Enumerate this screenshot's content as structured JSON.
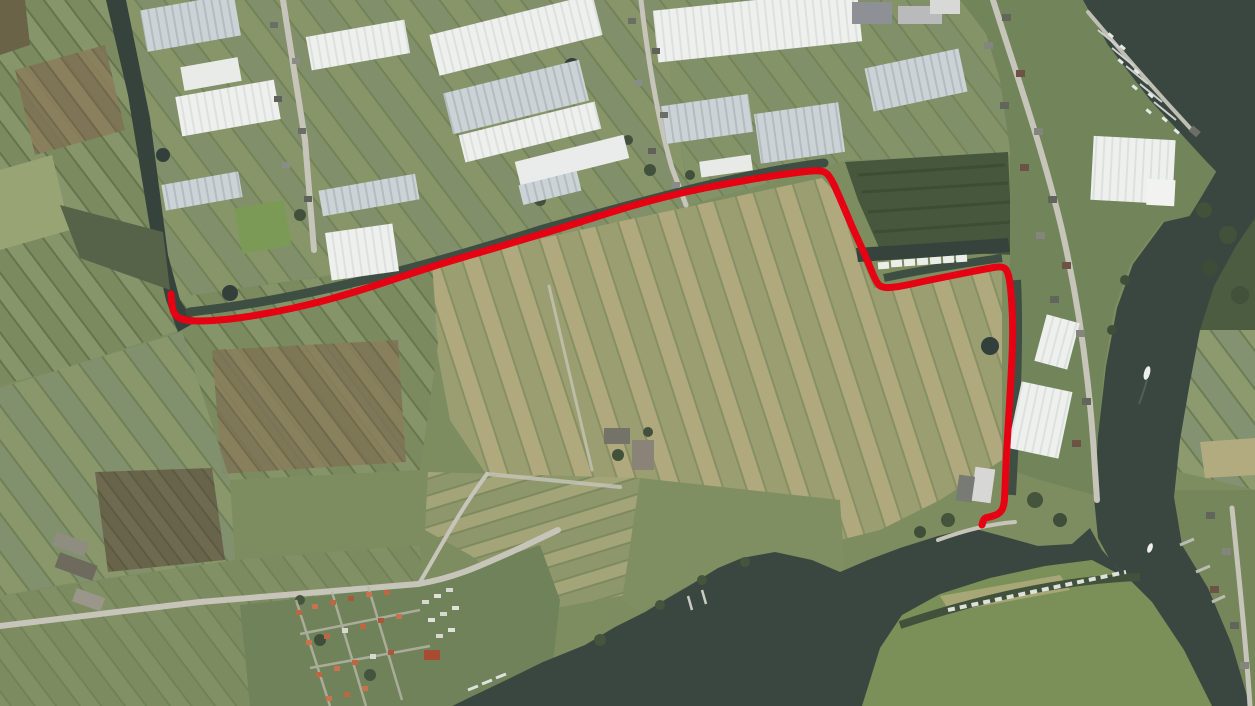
{
  "meta": {
    "type": "aerial-satellite-map",
    "description": "Aerial photo of a Dutch polder landscape with greenhouses, ribbon villages, a river system and a lake; a red route line is drawn along field ditches from a canal end in the west to a farm near the river in the south-east.",
    "visible_text": "none"
  },
  "route": {
    "color": "#e60113",
    "width": 7,
    "style": "solid",
    "points": [
      [
        171,
        294
      ],
      [
        172,
        308
      ],
      [
        176,
        317
      ],
      [
        188,
        321
      ],
      [
        210,
        321
      ],
      [
        240,
        318
      ],
      [
        275,
        312
      ],
      [
        312,
        304
      ],
      [
        352,
        293
      ],
      [
        395,
        279
      ],
      [
        440,
        264
      ],
      [
        485,
        251
      ],
      [
        525,
        239
      ],
      [
        565,
        227
      ],
      [
        605,
        214
      ],
      [
        645,
        202
      ],
      [
        685,
        192
      ],
      [
        725,
        184
      ],
      [
        765,
        177
      ],
      [
        800,
        172
      ],
      [
        822,
        170
      ],
      [
        830,
        176
      ],
      [
        840,
        198
      ],
      [
        853,
        229
      ],
      [
        866,
        257
      ],
      [
        876,
        282
      ],
      [
        882,
        288
      ],
      [
        898,
        287
      ],
      [
        925,
        281
      ],
      [
        955,
        275
      ],
      [
        985,
        269
      ],
      [
        1002,
        266
      ],
      [
        1008,
        271
      ],
      [
        1011,
        290
      ],
      [
        1013,
        325
      ],
      [
        1012,
        360
      ],
      [
        1010,
        395
      ],
      [
        1008,
        430
      ],
      [
        1006,
        462
      ],
      [
        1005,
        490
      ],
      [
        1004,
        507
      ],
      [
        999,
        514
      ],
      [
        990,
        517
      ],
      [
        984,
        518
      ],
      [
        982,
        525
      ]
    ]
  },
  "palette": {
    "water": "#3a4741",
    "water_dark": "#333f3a",
    "field_green": "#7d8d60",
    "field_green_light": "#8d9c6c",
    "field_tan": "#b0a97e",
    "field_brown": "#8a7e5c",
    "hedge_dark": "#46543e",
    "greenhouse_white": "#edefee",
    "greenhouse_glass": "#c6cfd3",
    "road_gray": "#c7c5ba",
    "roof_orange": "#bd6742",
    "boat_white": "#e6e8e4"
  },
  "features": [
    {
      "name": "left-canal",
      "desc": "dark canal running diagonally in the north-west, ending at the route start"
    },
    {
      "name": "greenhouse-belt",
      "desc": "band of white and glass greenhouses across the upper third"
    },
    {
      "name": "big-striped-field",
      "desc": "large tan striped polder field in the centre, bounded by the red route"
    },
    {
      "name": "river",
      "desc": "dark river entering top-right corner, bending south along the east side"
    },
    {
      "name": "marina",
      "desc": "jetties with small boats in the top-right river corner"
    },
    {
      "name": "houseboat-row",
      "desc": "row of white houseboats along canal north of the route's horizontal leg"
    },
    {
      "name": "holiday-park",
      "desc": "cottage park with orange roofs and caravans in the south-west"
    },
    {
      "name": "lake",
      "desc": "wide dark water body across the bottom centre"
    },
    {
      "name": "boat-lined-bank",
      "desc": "moored boats along the north edge of the south-east pasture"
    },
    {
      "name": "route-overlay",
      "desc": "red GPS-style route line with hooked start and end"
    }
  ]
}
